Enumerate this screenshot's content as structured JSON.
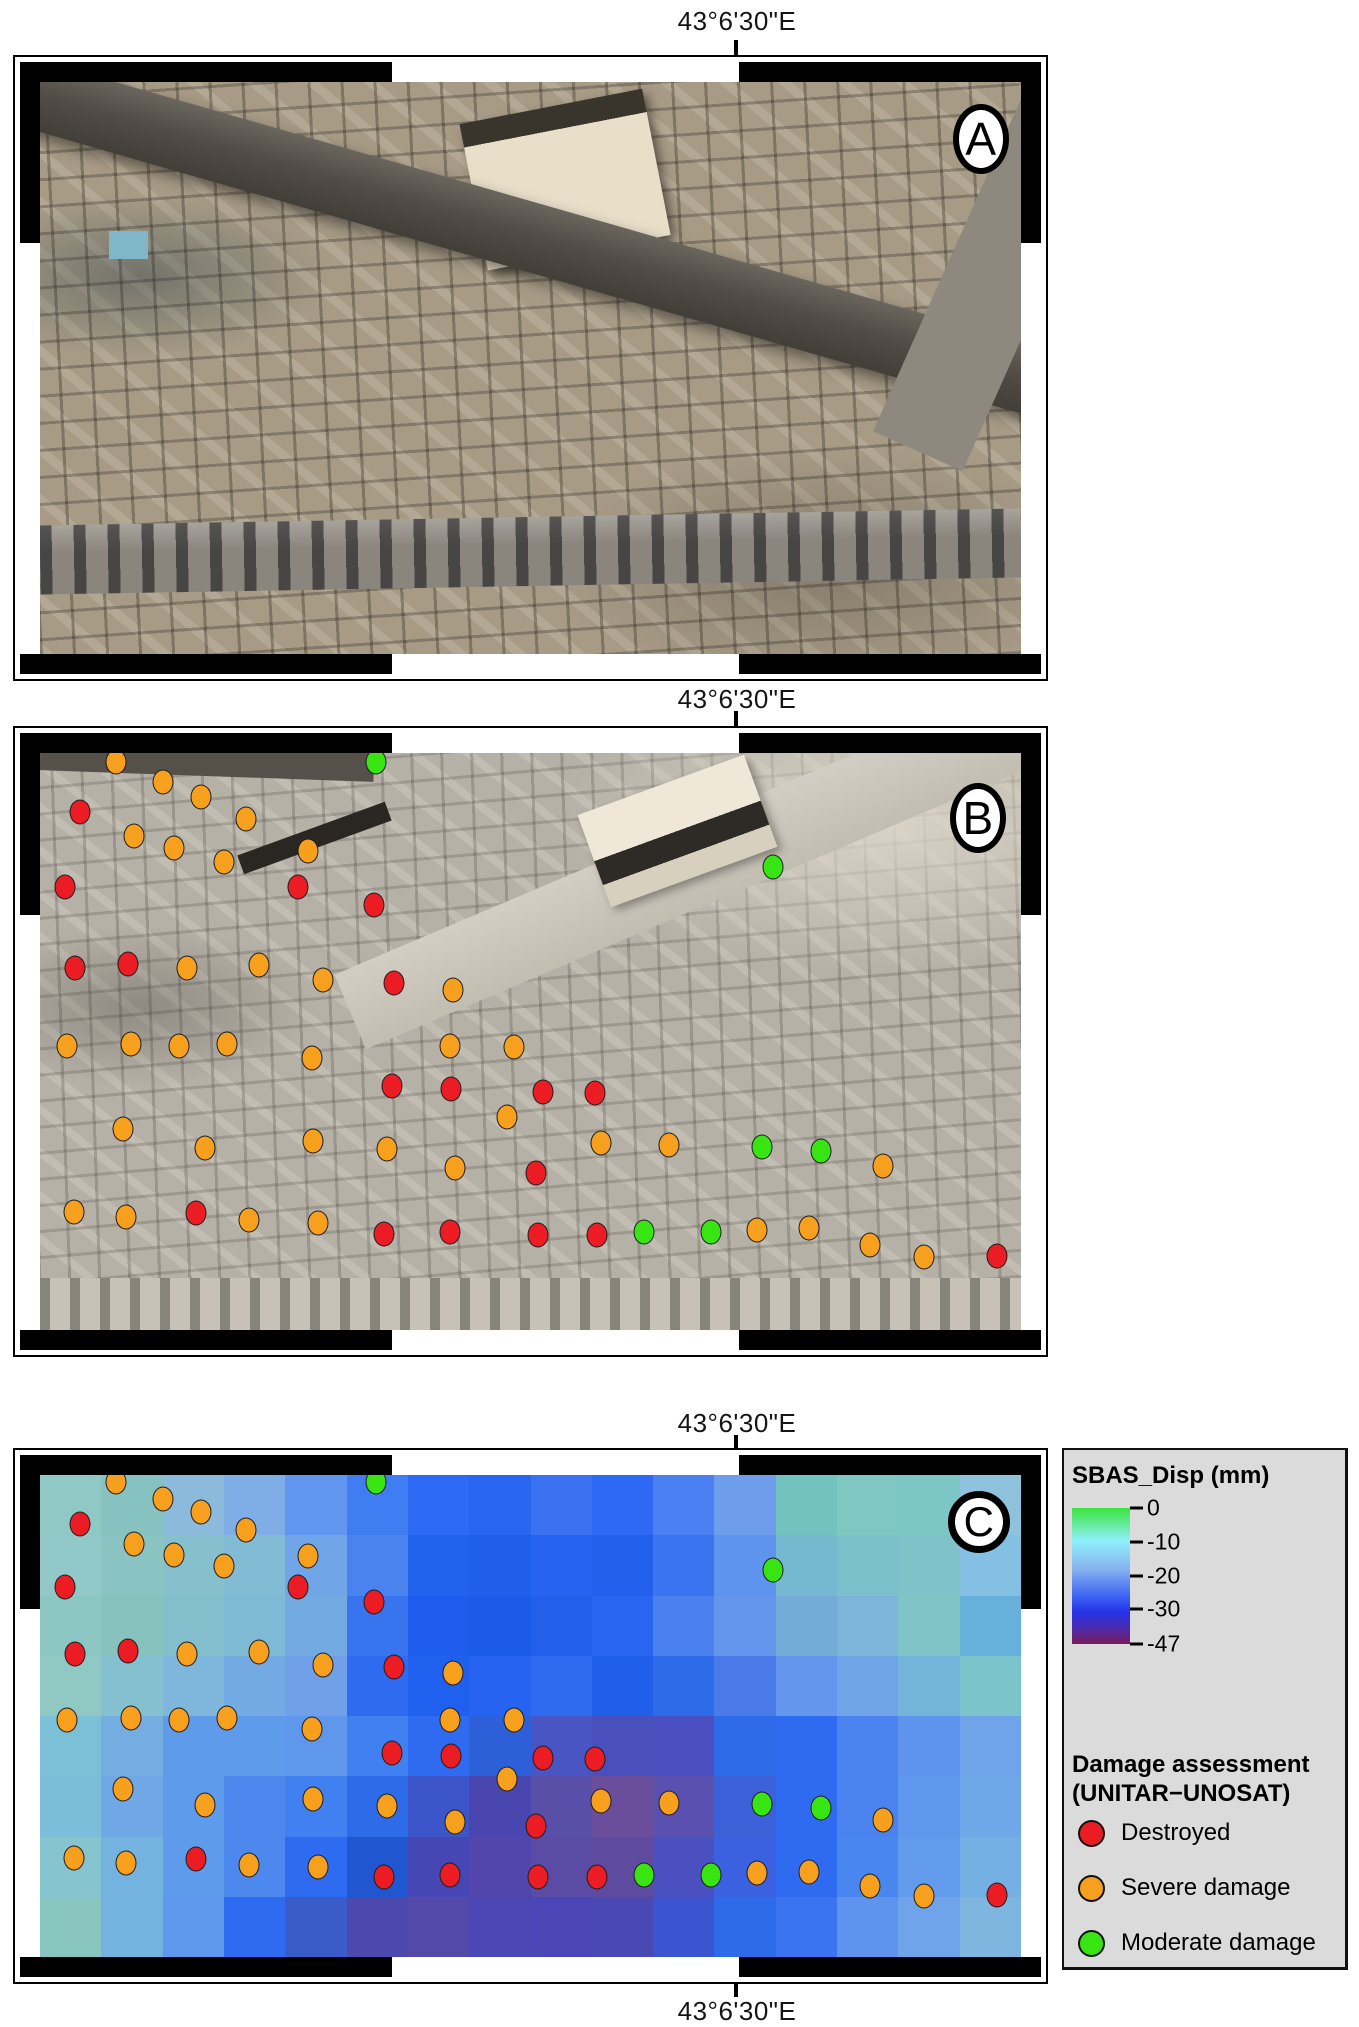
{
  "coordinate_label": "43°6'30\"E",
  "panels": [
    {
      "letter": "A"
    },
    {
      "letter": "B"
    },
    {
      "letter": "C"
    }
  ],
  "sbas_legend": {
    "title": "SBAS_Disp (mm)",
    "ticks": [
      {
        "label": "0",
        "p": 0.0
      },
      {
        "label": "-10",
        "p": 0.25
      },
      {
        "label": "-20",
        "p": 0.5
      },
      {
        "label": "-30",
        "p": 0.745
      },
      {
        "label": "-47",
        "p": 1.0
      }
    ],
    "ramp": [
      {
        "c": "#3be43c",
        "p": 0.0
      },
      {
        "c": "#8ef0fb",
        "p": 0.24
      },
      {
        "c": "#86b2f0",
        "p": 0.45
      },
      {
        "c": "#3d63f2",
        "p": 0.65
      },
      {
        "c": "#2433e8",
        "p": 0.76
      },
      {
        "c": "#4a2bae",
        "p": 0.88
      },
      {
        "c": "#7a1b5a",
        "p": 1.0
      }
    ]
  },
  "damage_legend": {
    "title_line1": "Damage assessment",
    "title_line2": "(UNITAR−UNOSAT)",
    "items": [
      {
        "key": "destroyed",
        "label": "Destroyed",
        "color": "#ec1c24"
      },
      {
        "key": "severe",
        "label": "Severe damage",
        "color": "#f6a01e"
      },
      {
        "key": "moderate",
        "label": "Moderate damage",
        "color": "#38e512"
      }
    ]
  },
  "damage_points": [
    {
      "k": "severe",
      "x": 7.7,
      "y": 1.5
    },
    {
      "k": "moderate",
      "x": 34.3,
      "y": 1.5
    },
    {
      "k": "severe",
      "x": 12.5,
      "y": 5.0
    },
    {
      "k": "severe",
      "x": 16.4,
      "y": 7.6
    },
    {
      "k": "destroyed",
      "x": 4.1,
      "y": 10.2
    },
    {
      "k": "severe",
      "x": 21.0,
      "y": 11.4
    },
    {
      "k": "severe",
      "x": 9.6,
      "y": 14.3
    },
    {
      "k": "severe",
      "x": 13.7,
      "y": 16.5
    },
    {
      "k": "severe",
      "x": 27.3,
      "y": 16.9
    },
    {
      "k": "severe",
      "x": 18.8,
      "y": 18.9
    },
    {
      "k": "destroyed",
      "x": 2.5,
      "y": 23.2
    },
    {
      "k": "destroyed",
      "x": 26.3,
      "y": 23.2
    },
    {
      "k": "destroyed",
      "x": 34.0,
      "y": 26.3
    },
    {
      "k": "moderate",
      "x": 74.7,
      "y": 19.8
    },
    {
      "k": "destroyed",
      "x": 3.6,
      "y": 37.2
    },
    {
      "k": "destroyed",
      "x": 9.0,
      "y": 36.5
    },
    {
      "k": "severe",
      "x": 15.0,
      "y": 37.2
    },
    {
      "k": "severe",
      "x": 22.3,
      "y": 36.8
    },
    {
      "k": "severe",
      "x": 28.8,
      "y": 39.4
    },
    {
      "k": "destroyed",
      "x": 36.1,
      "y": 39.8
    },
    {
      "k": "severe",
      "x": 42.1,
      "y": 41.1
    },
    {
      "k": "severe",
      "x": 2.8,
      "y": 50.8
    },
    {
      "k": "severe",
      "x": 9.3,
      "y": 50.4
    },
    {
      "k": "severe",
      "x": 14.2,
      "y": 50.8
    },
    {
      "k": "severe",
      "x": 19.1,
      "y": 50.4
    },
    {
      "k": "severe",
      "x": 27.7,
      "y": 52.8
    },
    {
      "k": "severe",
      "x": 41.8,
      "y": 50.8
    },
    {
      "k": "severe",
      "x": 48.3,
      "y": 50.9
    },
    {
      "k": "destroyed",
      "x": 35.9,
      "y": 57.7
    },
    {
      "k": "destroyed",
      "x": 41.9,
      "y": 58.3
    },
    {
      "k": "destroyed",
      "x": 51.3,
      "y": 58.7
    },
    {
      "k": "destroyed",
      "x": 56.6,
      "y": 58.9
    },
    {
      "k": "severe",
      "x": 47.6,
      "y": 63.0
    },
    {
      "k": "severe",
      "x": 8.5,
      "y": 65.2
    },
    {
      "k": "severe",
      "x": 16.8,
      "y": 68.5
    },
    {
      "k": "severe",
      "x": 27.8,
      "y": 67.3
    },
    {
      "k": "severe",
      "x": 35.4,
      "y": 68.7
    },
    {
      "k": "severe",
      "x": 42.3,
      "y": 71.9
    },
    {
      "k": "destroyed",
      "x": 50.6,
      "y": 72.8
    },
    {
      "k": "severe",
      "x": 57.2,
      "y": 67.6
    },
    {
      "k": "severe",
      "x": 64.1,
      "y": 68.0
    },
    {
      "k": "moderate",
      "x": 73.6,
      "y": 68.3
    },
    {
      "k": "moderate",
      "x": 79.6,
      "y": 69.0
    },
    {
      "k": "severe",
      "x": 85.9,
      "y": 71.6
    },
    {
      "k": "severe",
      "x": 3.5,
      "y": 79.5
    },
    {
      "k": "severe",
      "x": 8.8,
      "y": 80.4
    },
    {
      "k": "destroyed",
      "x": 15.9,
      "y": 79.7
    },
    {
      "k": "severe",
      "x": 21.3,
      "y": 80.9
    },
    {
      "k": "severe",
      "x": 28.3,
      "y": 81.4
    },
    {
      "k": "destroyed",
      "x": 35.1,
      "y": 83.3
    },
    {
      "k": "destroyed",
      "x": 41.8,
      "y": 83.0
    },
    {
      "k": "destroyed",
      "x": 50.8,
      "y": 83.5
    },
    {
      "k": "destroyed",
      "x": 56.8,
      "y": 83.5
    },
    {
      "k": "moderate",
      "x": 61.6,
      "y": 83.0
    },
    {
      "k": "moderate",
      "x": 68.4,
      "y": 83.0
    },
    {
      "k": "severe",
      "x": 73.1,
      "y": 82.6
    },
    {
      "k": "severe",
      "x": 78.4,
      "y": 82.4
    },
    {
      "k": "severe",
      "x": 84.6,
      "y": 85.2
    },
    {
      "k": "severe",
      "x": 90.1,
      "y": 87.4
    },
    {
      "k": "destroyed",
      "x": 97.6,
      "y": 87.1
    }
  ],
  "sbas_raster": {
    "cols": 16,
    "rows": 8,
    "cells": [
      "#8fc8c4",
      "#86c2c0",
      "#8cbadc",
      "#7faee6",
      "#6096f0",
      "#407cf2",
      "#2e6bf4",
      "#2866f0",
      "#3b72f2",
      "#2e68f4",
      "#4a80f2",
      "#6e9dec",
      "#74c2c0",
      "#7fc8c2",
      "#7cc6c6",
      "#8fc2dc",
      "#92c8c8",
      "#8ac4c2",
      "#86c0cc",
      "#82bcd4",
      "#70a6e8",
      "#4a82f0",
      "#2263ee",
      "#1f5fea",
      "#2663f0",
      "#2260ec",
      "#3b74f0",
      "#5e93ee",
      "#76b8d0",
      "#7cc0cc",
      "#7fc2ca",
      "#84c0e4",
      "#8cc6c2",
      "#86c2be",
      "#82becc",
      "#7ebad4",
      "#74aae2",
      "#3874ee",
      "#1d5cec",
      "#1c5ae8",
      "#2260ec",
      "#2866f0",
      "#4a80f0",
      "#6396ec",
      "#74acd8",
      "#7cb4da",
      "#80c4c8",
      "#68b0dc",
      "#90c8c4",
      "#84c0d0",
      "#7fb6dc",
      "#74aae4",
      "#6fa0e8",
      "#2e6bf0",
      "#2060ee",
      "#2563f0",
      "#2e6bf0",
      "#2060e8",
      "#2e6be8",
      "#4a7be8",
      "#6396ec",
      "#6fa4e8",
      "#74b4d8",
      "#7cc4cc",
      "#7cc0d8",
      "#74aee0",
      "#5e9bea",
      "#5e9bea",
      "#5e97ec",
      "#4080f0",
      "#2e6bf0",
      "#2d60d8",
      "#4a55c4",
      "#4a4fbe",
      "#4a50c0",
      "#2e6be8",
      "#2e6bf0",
      "#4a82f0",
      "#5e93ee",
      "#6fa4ea",
      "#7cbeda",
      "#6fa8e4",
      "#5e9bea",
      "#4c88ee",
      "#4080f0",
      "#2e6be8",
      "#3c55c8",
      "#4a46b0",
      "#5a4fa8",
      "#6b4e9b",
      "#5a50b0",
      "#3b60d8",
      "#2e6bf0",
      "#4a82f0",
      "#5e97ec",
      "#6fa8e8",
      "#86c4d0",
      "#74b2e0",
      "#5e9bea",
      "#4c88ee",
      "#2e6bf0",
      "#2056d0",
      "#4646b4",
      "#5246ac",
      "#5a4ba4",
      "#5e4ba0",
      "#4a50c0",
      "#3b60e0",
      "#2e6bf0",
      "#4a86f0",
      "#639bec",
      "#74b0e4",
      "#8ac6c0",
      "#74b2e0",
      "#5e97ec",
      "#2e6bf0",
      "#3a5cc8",
      "#4c49ae",
      "#5349a8",
      "#4a46b4",
      "#4a46b8",
      "#4a49b4",
      "#3b55d0",
      "#2e6be8",
      "#3b74f0",
      "#5e93ee",
      "#6fa4ea",
      "#7fb6e0"
    ]
  }
}
